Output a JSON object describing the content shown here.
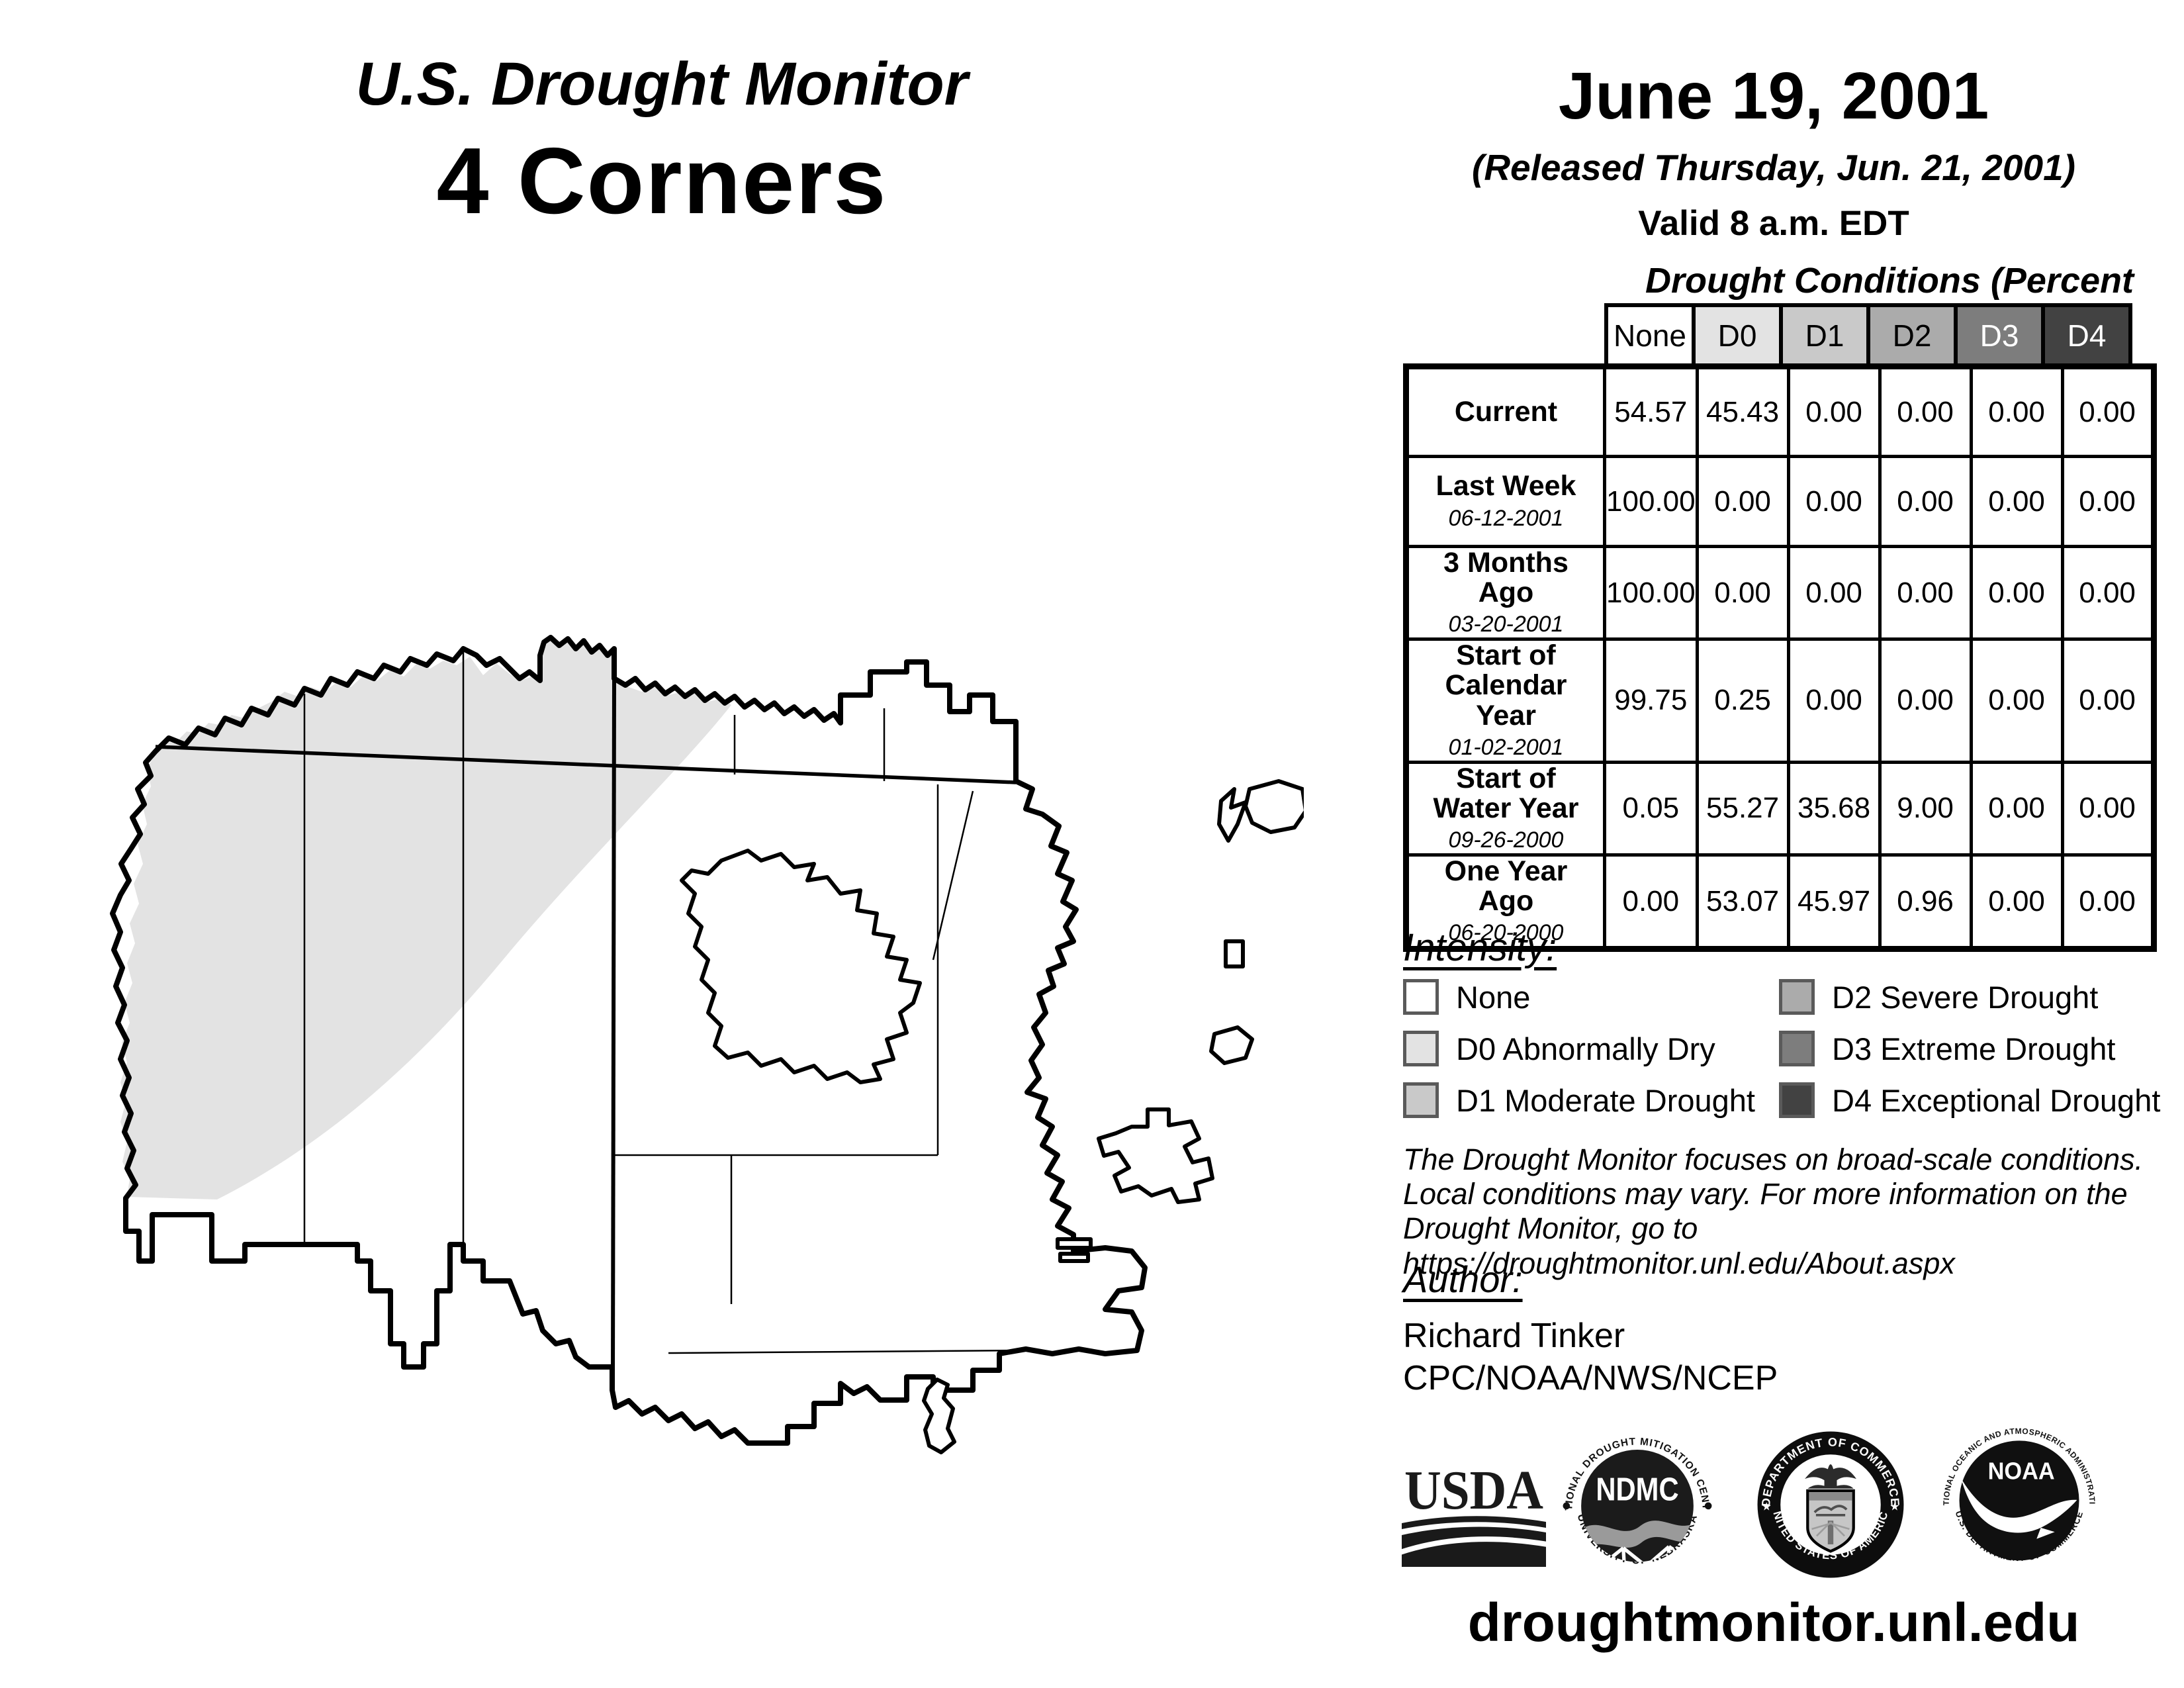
{
  "header": {
    "title": "U.S. Drought Monitor",
    "region": "4 Corners",
    "date": "June 19, 2001",
    "released": "(Released Thursday, Jun. 21, 2001)",
    "valid": "Valid 8 a.m. EDT"
  },
  "table": {
    "title": "Drought Conditions (Percent Area)",
    "columns": [
      "None",
      "D0",
      "D1",
      "D2",
      "D3",
      "D4"
    ],
    "rows": [
      {
        "label": "Current",
        "date": "",
        "values": [
          "54.57",
          "45.43",
          "0.00",
          "0.00",
          "0.00",
          "0.00"
        ]
      },
      {
        "label": "Last Week",
        "date": "06-12-2001",
        "values": [
          "100.00",
          "0.00",
          "0.00",
          "0.00",
          "0.00",
          "0.00"
        ]
      },
      {
        "label": "3 Months Ago",
        "date": "03-20-2001",
        "values": [
          "100.00",
          "0.00",
          "0.00",
          "0.00",
          "0.00",
          "0.00"
        ]
      },
      {
        "label": "Start of Calendar Year",
        "date": "01-02-2001",
        "values": [
          "99.75",
          "0.25",
          "0.00",
          "0.00",
          "0.00",
          "0.00"
        ]
      },
      {
        "label": "Start of Water Year",
        "date": "09-26-2000",
        "values": [
          "0.05",
          "55.27",
          "35.68",
          "9.00",
          "0.00",
          "0.00"
        ]
      },
      {
        "label": "One Year Ago",
        "date": "06-20-2000",
        "values": [
          "0.00",
          "53.07",
          "45.97",
          "0.96",
          "0.00",
          "0.00"
        ]
      }
    ]
  },
  "legend": {
    "title": "Intensity:",
    "items": [
      {
        "label": "None",
        "color": "#ffffff"
      },
      {
        "label": "D0 Abnormally Dry",
        "color": "#e3e3e3"
      },
      {
        "label": "D1 Moderate Drought",
        "color": "#c9c9c9"
      },
      {
        "label": "D2 Severe Drought",
        "color": "#ababab"
      },
      {
        "label": "D3 Extreme Drought",
        "color": "#7d7d7d"
      },
      {
        "label": "D4 Exceptional Drought",
        "color": "#424242"
      }
    ]
  },
  "disclaimer": {
    "line1": "The Drought Monitor focuses on broad-scale conditions.",
    "line2": "Local conditions may vary. For more information on the",
    "line3": "Drought Monitor, go to https://droughtmonitor.unl.edu/About.aspx"
  },
  "author": {
    "heading": "Author:",
    "name": "Richard Tinker",
    "org": "CPC/NOAA/NWS/NCEP"
  },
  "logos": {
    "usda": "USDA",
    "ndmc_center": "NDMC",
    "ndmc_top": "NATIONAL DROUGHT MITIGATION CENTER",
    "ndmc_bottom": "UNIVERSITY OF NEBRASKA",
    "doc_top": "DEPARTMENT OF COMMERCE",
    "doc_bottom": "UNITED STATES OF AMERICA",
    "noaa_center": "NOAA",
    "noaa_top": "NATIONAL OCEANIC AND ATMOSPHERIC ADMINISTRATION",
    "noaa_bottom": "U.S. DEPARTMENT OF COMMERCE"
  },
  "footer": {
    "url": "droughtmonitor.unl.edu"
  }
}
